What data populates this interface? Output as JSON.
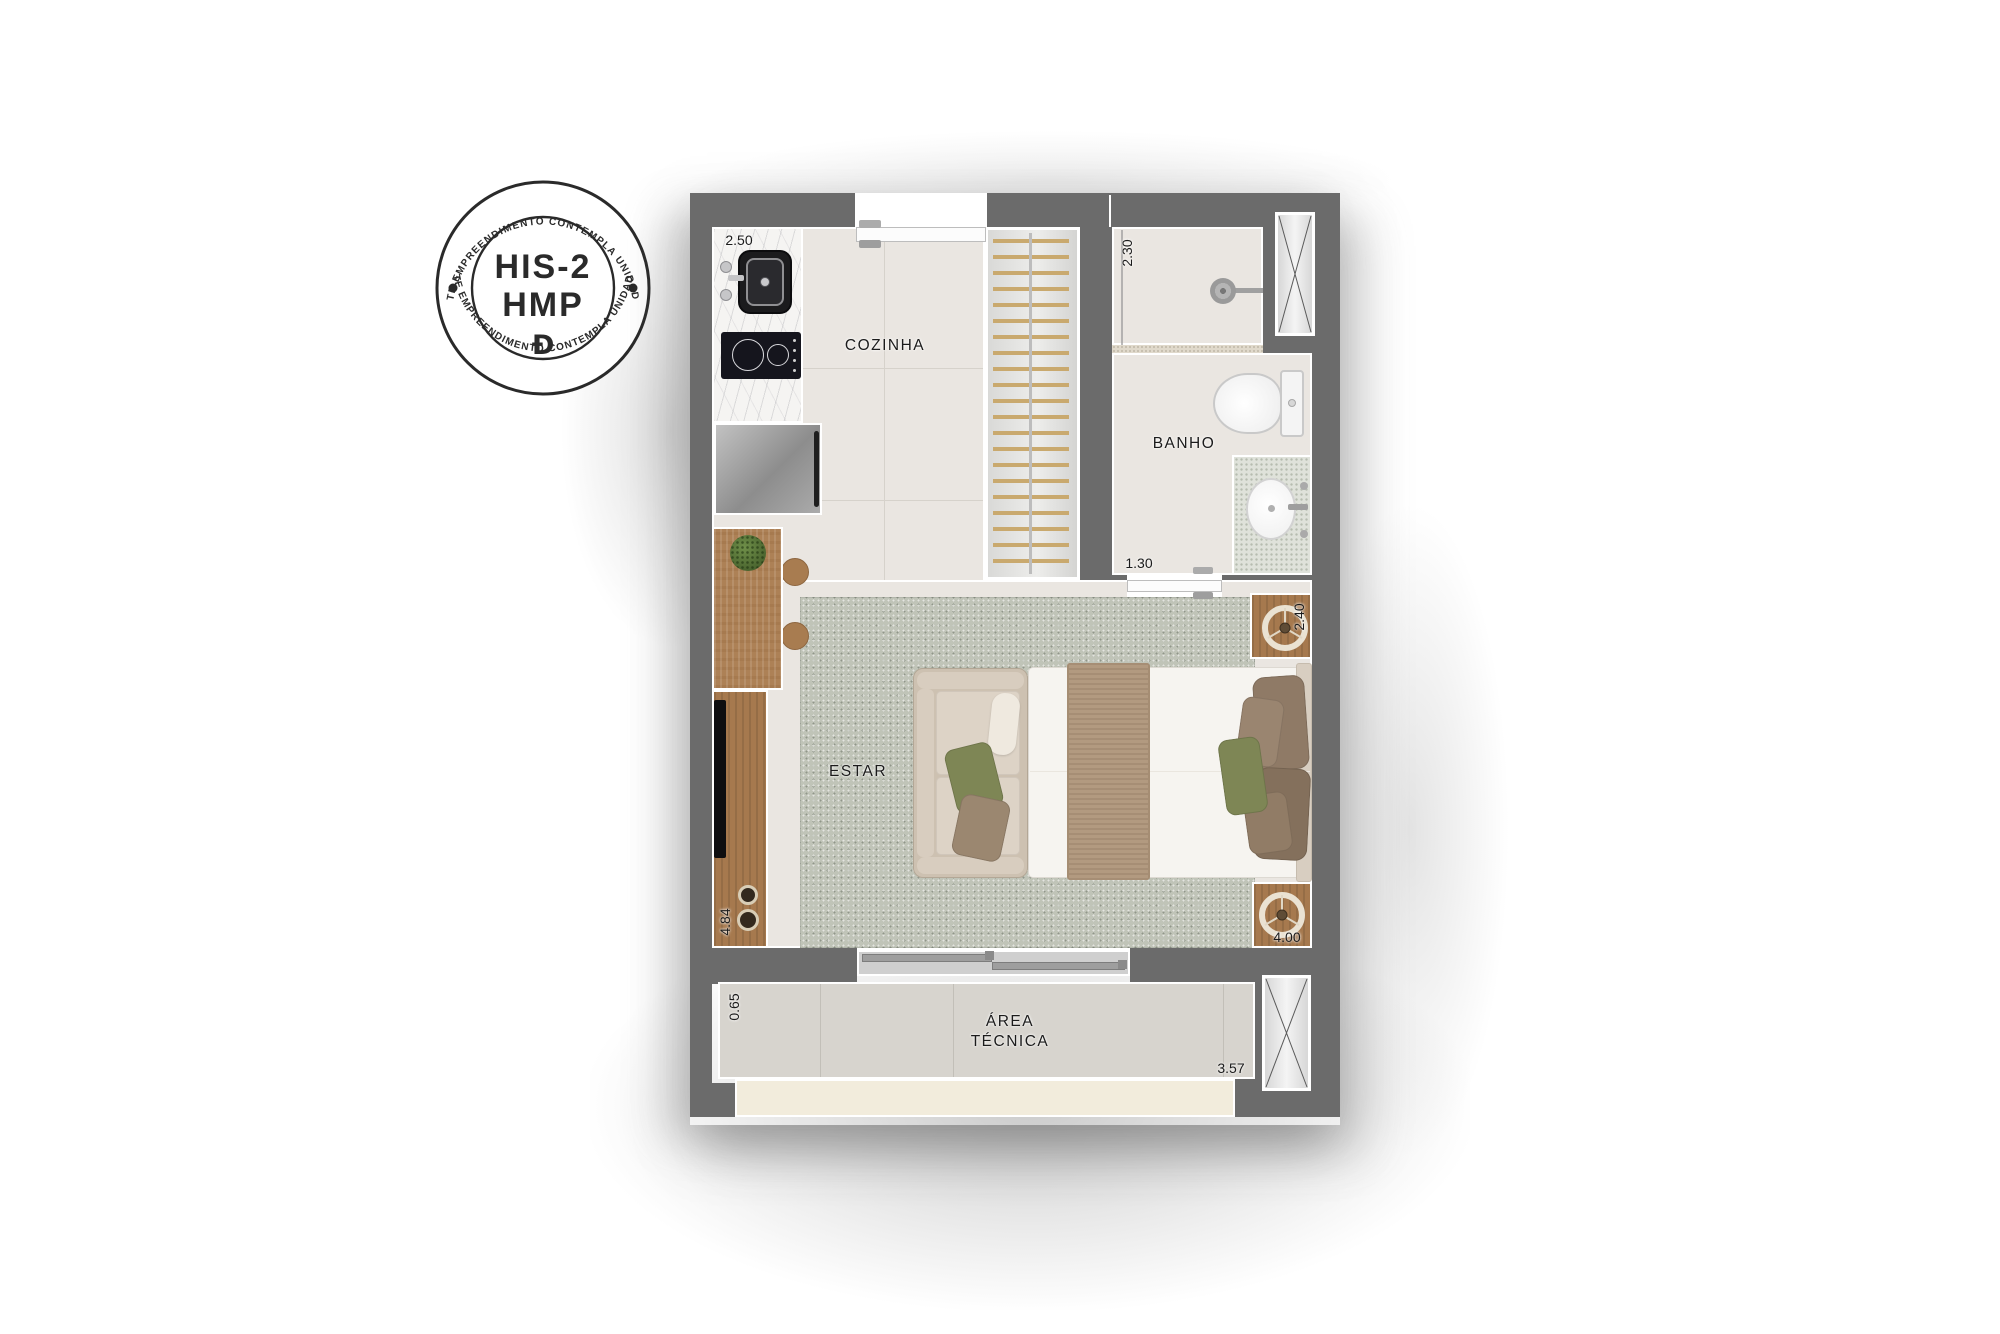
{
  "badge": {
    "arc_text_top": "ESTE EMPREENDIMENTO CONTEMPLA UNIDADES",
    "arc_text_bottom": "ESTE EMPREENDIMENTO CONTEMPLA UNIDADES",
    "title_line1": "HIS-2",
    "title_line2": "HMP",
    "logo_glyph": "Ɖ",
    "ink_color": "#2a2a2a"
  },
  "plan": {
    "rooms": {
      "cozinha": "COZINHA",
      "banho": "BANHO",
      "estar": "ESTAR",
      "area_tecnica": "ÁREA TÉCNICA"
    },
    "dims": {
      "kitchen_width": "2.50",
      "bath_length": "2.30",
      "bath_width": "1.30",
      "bed_width": "2.40",
      "living_length": "4.84",
      "living_width": "4.00",
      "tech_area_depth": "0.65",
      "tech_area_width": "3.57"
    },
    "furniture": [
      "kitchen-sink",
      "cooktop",
      "washing-machine",
      "dining-table",
      "plant",
      "stools",
      "tv-console",
      "tv",
      "sofa",
      "bed",
      "nightstands",
      "wardrobe-hangers",
      "toilet",
      "shower",
      "vanity-sink",
      "sliding-door",
      "entry-door",
      "bathroom-door",
      "ventilation-shafts",
      "rug"
    ],
    "colors": {
      "wall": "#6b6b6b",
      "floor": "#eae6e1",
      "rug": "#c0c4b8",
      "wood": "#ad8156",
      "marble": "#f5f4f2",
      "appliance_gray": "#a7a7a7",
      "bed_blanket": "#b29a80",
      "pillow_green": "#7e8655",
      "pillow_brown": "#8d7864",
      "sofa": "#cdc1b1",
      "tech_area_floor": "#d7d4ce",
      "balcony_slab": "#f2ecdc",
      "hanger": "#c9a96e"
    }
  }
}
